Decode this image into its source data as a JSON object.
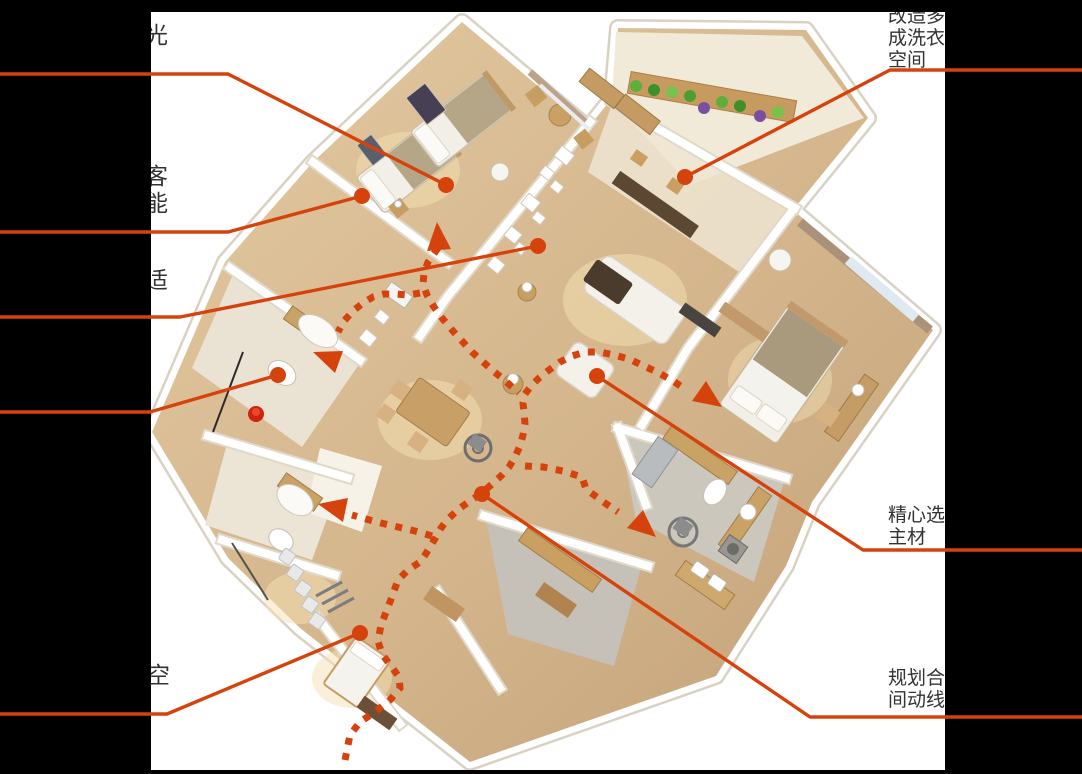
{
  "colors": {
    "annotation": "#d6420c",
    "mask": "#000000"
  },
  "labels": {
    "left": [
      {
        "id": "label-light",
        "lines": [
          "光"
        ]
      },
      {
        "id": "label-guest",
        "lines": [
          "客",
          "能"
        ]
      },
      {
        "id": "label-comfort",
        "lines": [
          "适"
        ]
      },
      {
        "id": "label-space",
        "lines": [
          "空"
        ]
      }
    ],
    "right": [
      {
        "id": "label-laundry",
        "lines": [
          "改造多",
          "成洗衣",
          "空间"
        ]
      },
      {
        "id": "label-materials",
        "lines": [
          "精心选",
          "主材"
        ]
      },
      {
        "id": "label-circulation",
        "lines": [
          "规划合",
          "间动线"
        ]
      }
    ]
  }
}
